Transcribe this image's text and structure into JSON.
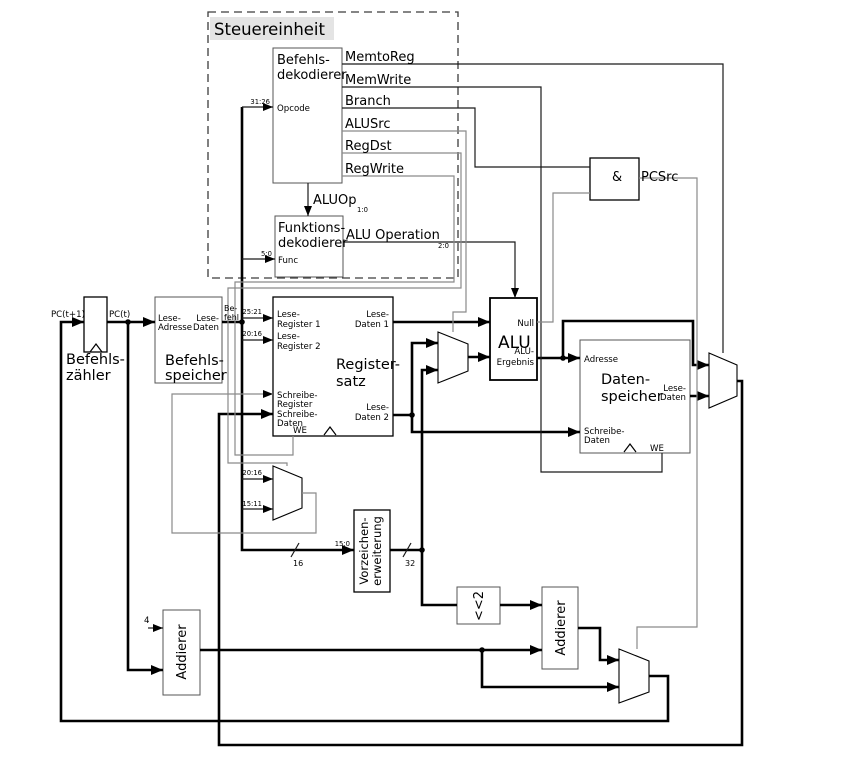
{
  "colors": {
    "background": "#ffffff",
    "data_wire": "#000000",
    "control_wire": "#8a8a8a",
    "title_highlight": "#e4e4e4"
  },
  "control_unit": {
    "title": "Steuereinheit",
    "instruction_decoder": {
      "name": [
        "Befehls-",
        "dekodierer"
      ],
      "input": "Opcode",
      "input_bits": "31:26"
    },
    "signals": [
      "MemtoReg",
      "MemWrite",
      "Branch",
      "ALUSrc",
      "RegDst",
      "RegWrite"
    ],
    "aluop_label": "ALUOp",
    "aluop_bits": "1:0",
    "function_decoder": {
      "name": [
        "Funktions-",
        "dekodierer"
      ],
      "input": "Func",
      "input_bits": "5:0"
    },
    "alu_operation_label": "ALU Operation",
    "alu_operation_bits": "2:0"
  },
  "and_gate": {
    "symbol": "&",
    "output": "PCSrc"
  },
  "program_counter": {
    "name": [
      "Befehls-",
      "zähler"
    ],
    "input": "PC(t+1)",
    "output": "PC(t)"
  },
  "increment": "4",
  "instruction_memory": {
    "name": [
      "Befehls-",
      "speicher"
    ],
    "read_address": [
      "Lese-",
      "Adresse"
    ],
    "read_data": [
      "Lese-",
      "Daten"
    ],
    "instruction": [
      "Be-",
      "fehl"
    ]
  },
  "register_file": {
    "name": [
      "Register-",
      "satz"
    ],
    "read_register_1": [
      "Lese-",
      "Register 1"
    ],
    "read_register_1_bits": "25:21",
    "read_register_2": [
      "Lese-",
      "Register 2"
    ],
    "read_register_2_bits": "20:16",
    "write_register": [
      "Schreibe-",
      "Register"
    ],
    "write_data": [
      "Schreibe-",
      "Daten"
    ],
    "read_data_1": [
      "Lese-",
      "Daten 1"
    ],
    "read_data_2": [
      "Lese-",
      "Daten 2"
    ],
    "write_enable": "WE"
  },
  "regdst_mux": {
    "input_1_bits": "20:16",
    "input_2_bits": "15:11"
  },
  "sign_extend": {
    "name": [
      "Vorzeichen-",
      "erweiterung"
    ],
    "input_bits": "15:0",
    "input_width": "16",
    "output_width": "32"
  },
  "alu": {
    "name": "ALU",
    "zero": "Null",
    "result": [
      "ALU-",
      "Ergebnis"
    ]
  },
  "data_memory": {
    "name": [
      "Daten-",
      "speicher"
    ],
    "address": "Adresse",
    "write_data": [
      "Schreibe-",
      "Daten"
    ],
    "read_data": [
      "Lese-",
      "Daten"
    ],
    "write_enable": "WE"
  },
  "shift_left": "<<2",
  "pc_adder": "Addierer",
  "branch_adder": "Addierer"
}
